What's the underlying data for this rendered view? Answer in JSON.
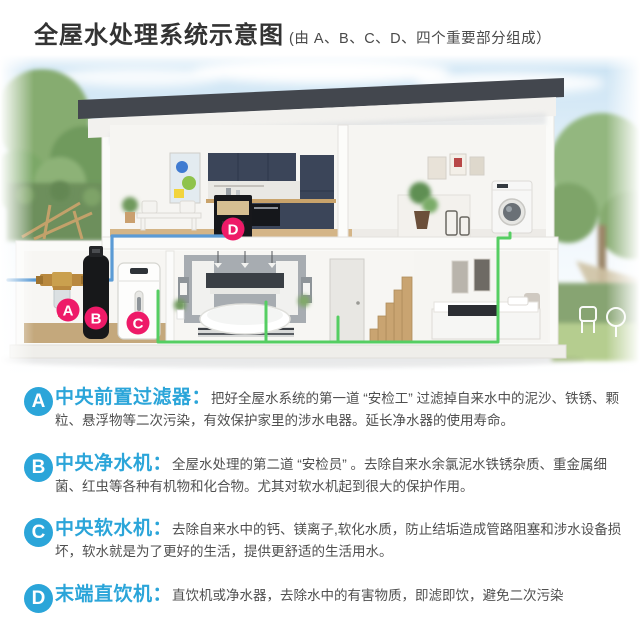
{
  "header": {
    "title": "全屋水处理系统示意图",
    "subtitle": "(由 A、B、C、D、四个重要部分组成）"
  },
  "illustration": {
    "description": "house-cross-section-with-water-treatment-devices",
    "markers": [
      {
        "letter": "A"
      },
      {
        "letter": "B"
      },
      {
        "letter": "C"
      },
      {
        "letter": "D"
      }
    ],
    "colors": {
      "accent_blue": "#2ba5d9",
      "marker_pink": "#ee1a68",
      "pipe_blue": "#5b9bd5",
      "pipe_green": "#55ce62",
      "roof_dark": "#43474e",
      "cabinet_navy": "#3b4559"
    }
  },
  "sections": [
    {
      "letter": "A",
      "title": "中央前置过滤器：",
      "desc": "把好全屋水系统的第一道 “安检工” 过滤掉自来水中的泥沙、铁锈、颗粒、悬浮物等二次污染，有效保护家里的涉水电器。延长净水器的使用寿命。"
    },
    {
      "letter": "B",
      "title": "中央净水机：",
      "desc": "全屋水处理的第二道 “安检员” 。去除自来水余氯泥水铁锈杂质、重金属细菌、红虫等各种有机物和化合物。尤其对软水机起到很大的保护作用。"
    },
    {
      "letter": "C",
      "title": "中央软水机：",
      "desc": "去除自来水中的钙、镁离子,软化水质，防止结垢造成管路阻塞和涉水设备损坏，软水就是为了更好的生活，提供更舒适的生活用水。"
    },
    {
      "letter": "D",
      "title": "末端直饮机：",
      "desc": "直饮机或净水器，去除水中的有害物质，即滤即饮，避免二次污染"
    }
  ]
}
